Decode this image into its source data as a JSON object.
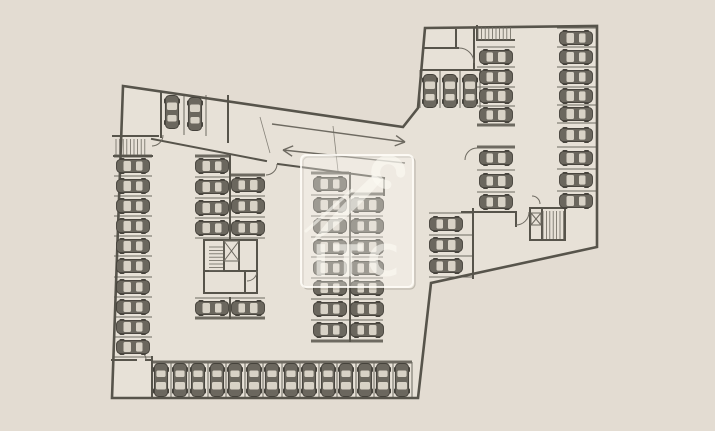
{
  "colors": {
    "background": "#e3dcd2",
    "floor": "#e7e1d7",
    "wall": "#57544b",
    "line": "#6e6a61",
    "car_body": "#6b675e",
    "car_outline": "#45423b",
    "car_window": "#d8d2c6",
    "watermark_fill": "rgba(255,252,246,0.35)",
    "watermark_stroke": "rgba(255,253,248,0.85)",
    "watermark_glyph": "rgba(252,250,244,0.6)"
  },
  "watermark": {
    "text": "ITC"
  },
  "plan": {
    "cars": [
      [
        172,
        112,
        90
      ],
      [
        195,
        114,
        90
      ],
      [
        133,
        166,
        0
      ],
      [
        133,
        186,
        0
      ],
      [
        133,
        206,
        0
      ],
      [
        133,
        226,
        0
      ],
      [
        133,
        246,
        0
      ],
      [
        133,
        266,
        0
      ],
      [
        133,
        287,
        0
      ],
      [
        133,
        307,
        0
      ],
      [
        133,
        327,
        0
      ],
      [
        133,
        347,
        0
      ],
      [
        212,
        166,
        0
      ],
      [
        212,
        187,
        0
      ],
      [
        212,
        208,
        0
      ],
      [
        212,
        228,
        0
      ],
      [
        212,
        308,
        0
      ],
      [
        248,
        185,
        180
      ],
      [
        248,
        206,
        180
      ],
      [
        248,
        228,
        180
      ],
      [
        248,
        308,
        180
      ],
      [
        330,
        184,
        0
      ],
      [
        330,
        205,
        0
      ],
      [
        330,
        226,
        0
      ],
      [
        330,
        247,
        0
      ],
      [
        330,
        268,
        0
      ],
      [
        330,
        288,
        0
      ],
      [
        330,
        309,
        0
      ],
      [
        330,
        330,
        0
      ],
      [
        367,
        205,
        180
      ],
      [
        367,
        226,
        180
      ],
      [
        367,
        247,
        180
      ],
      [
        367,
        268,
        180
      ],
      [
        367,
        288,
        180
      ],
      [
        367,
        309,
        180
      ],
      [
        367,
        330,
        180
      ],
      [
        161,
        380,
        -90
      ],
      [
        180,
        380,
        -90
      ],
      [
        198,
        380,
        -90
      ],
      [
        217,
        380,
        -90
      ],
      [
        235,
        380,
        -90
      ],
      [
        254,
        380,
        -90
      ],
      [
        272,
        380,
        -90
      ],
      [
        291,
        380,
        -90
      ],
      [
        309,
        380,
        -90
      ],
      [
        328,
        380,
        -90
      ],
      [
        346,
        380,
        -90
      ],
      [
        365,
        380,
        -90
      ],
      [
        383,
        380,
        -90
      ],
      [
        402,
        380,
        -90
      ],
      [
        430,
        91,
        90
      ],
      [
        450,
        91,
        90
      ],
      [
        470,
        91,
        90
      ],
      [
        496,
        57,
        180
      ],
      [
        496,
        77,
        180
      ],
      [
        496,
        96,
        180
      ],
      [
        496,
        115,
        180
      ],
      [
        496,
        158,
        180
      ],
      [
        496,
        181,
        180
      ],
      [
        496,
        202,
        180
      ],
      [
        576,
        38,
        0
      ],
      [
        576,
        57,
        0
      ],
      [
        576,
        77,
        0
      ],
      [
        576,
        96,
        0
      ],
      [
        576,
        114,
        0
      ],
      [
        576,
        135,
        0
      ],
      [
        576,
        158,
        0
      ],
      [
        576,
        180,
        0
      ],
      [
        576,
        201,
        0
      ],
      [
        446,
        224,
        180
      ],
      [
        446,
        245,
        180
      ],
      [
        446,
        266,
        180
      ]
    ],
    "stall_lines": [
      [
        114,
        176,
        152,
        176
      ],
      [
        114,
        196,
        152,
        196
      ],
      [
        114,
        216,
        152,
        216
      ],
      [
        114,
        236,
        152,
        236
      ],
      [
        114,
        256,
        152,
        256
      ],
      [
        114,
        277,
        152,
        277
      ],
      [
        114,
        297,
        152,
        297
      ],
      [
        114,
        317,
        152,
        317
      ],
      [
        114,
        337,
        152,
        337
      ],
      [
        114,
        357,
        152,
        357
      ],
      [
        184,
        94,
        184,
        135
      ],
      [
        206,
        95,
        206,
        136
      ],
      [
        195,
        177,
        229,
        177
      ],
      [
        195,
        198,
        229,
        198
      ],
      [
        195,
        218,
        229,
        218
      ],
      [
        195,
        238,
        229,
        238
      ],
      [
        231,
        196,
        265,
        196
      ],
      [
        231,
        217,
        265,
        217
      ],
      [
        231,
        238,
        265,
        238
      ],
      [
        195,
        298,
        229,
        298
      ],
      [
        231,
        298,
        265,
        298
      ],
      [
        311,
        195,
        349,
        195
      ],
      [
        311,
        216,
        349,
        216
      ],
      [
        311,
        237,
        349,
        237
      ],
      [
        311,
        257,
        349,
        257
      ],
      [
        311,
        278,
        349,
        278
      ],
      [
        311,
        299,
        349,
        299
      ],
      [
        311,
        320,
        349,
        320
      ],
      [
        351,
        216,
        383,
        216
      ],
      [
        351,
        237,
        383,
        237
      ],
      [
        351,
        257,
        383,
        257
      ],
      [
        351,
        278,
        383,
        278
      ],
      [
        351,
        299,
        383,
        299
      ],
      [
        351,
        320,
        383,
        320
      ],
      [
        171,
        362,
        171,
        398
      ],
      [
        189,
        362,
        189,
        398
      ],
      [
        208,
        362,
        208,
        398
      ],
      [
        226,
        362,
        226,
        398
      ],
      [
        245,
        362,
        245,
        398
      ],
      [
        263,
        362,
        263,
        398
      ],
      [
        282,
        362,
        282,
        398
      ],
      [
        300,
        362,
        300,
        398
      ],
      [
        319,
        362,
        319,
        398
      ],
      [
        337,
        362,
        337,
        398
      ],
      [
        356,
        362,
        356,
        398
      ],
      [
        374,
        362,
        374,
        398
      ],
      [
        393,
        362,
        393,
        398
      ],
      [
        412,
        362,
        412,
        398
      ],
      [
        420,
        70,
        420,
        108
      ],
      [
        440,
        70,
        440,
        108
      ],
      [
        460,
        70,
        460,
        108
      ],
      [
        480,
        70,
        480,
        108
      ],
      [
        477,
        47,
        515,
        47
      ],
      [
        477,
        67,
        515,
        67
      ],
      [
        477,
        87,
        515,
        87
      ],
      [
        477,
        106,
        515,
        106
      ],
      [
        477,
        170,
        515,
        170
      ],
      [
        477,
        192,
        515,
        192
      ],
      [
        557,
        28,
        596,
        28
      ],
      [
        557,
        47,
        596,
        47
      ],
      [
        557,
        67,
        596,
        67
      ],
      [
        557,
        87,
        596,
        87
      ],
      [
        557,
        105,
        596,
        105
      ],
      [
        557,
        123,
        596,
        123
      ],
      [
        557,
        147,
        596,
        147
      ],
      [
        557,
        169,
        596,
        169
      ],
      [
        557,
        191,
        596,
        191
      ],
      [
        429,
        213,
        473,
        213
      ],
      [
        429,
        235,
        473,
        235
      ],
      [
        429,
        256,
        473,
        256
      ],
      [
        429,
        277,
        473,
        277
      ]
    ],
    "caps": [
      [
        114,
        156,
        152,
        156
      ],
      [
        195,
        156,
        229,
        156
      ],
      [
        231,
        175,
        265,
        175
      ],
      [
        311,
        173,
        349,
        173
      ],
      [
        351,
        194,
        383,
        194
      ],
      [
        195,
        318,
        265,
        318
      ],
      [
        311,
        341,
        383,
        341
      ],
      [
        152,
        362,
        412,
        362
      ],
      [
        477,
        125,
        515,
        125
      ],
      [
        477,
        147,
        515,
        147
      ]
    ],
    "arrows": [
      {
        "x1": 272,
        "y1": 124,
        "x2": 405,
        "y2": 142
      },
      {
        "x1": 405,
        "y1": 163,
        "x2": 283,
        "y2": 150
      }
    ],
    "stairs": [
      {
        "x": 116,
        "y": 139,
        "w": 32,
        "h": 16,
        "dir": "v",
        "step": 3.6
      },
      {
        "x": 209,
        "y": 247,
        "w": 14,
        "h": 24,
        "dir": "h",
        "step": 3.4
      },
      {
        "x": 478,
        "y": 27,
        "w": 35,
        "h": 13,
        "dir": "v",
        "step": 3.6
      },
      {
        "x": 543,
        "y": 211,
        "w": 21,
        "h": 28,
        "dir": "v",
        "step": 3.4
      }
    ],
    "elevators": [
      {
        "x": 224,
        "y": 241,
        "w": 15,
        "h": 20
      },
      {
        "x": 531,
        "y": 213,
        "w": 10,
        "h": 12
      }
    ]
  }
}
